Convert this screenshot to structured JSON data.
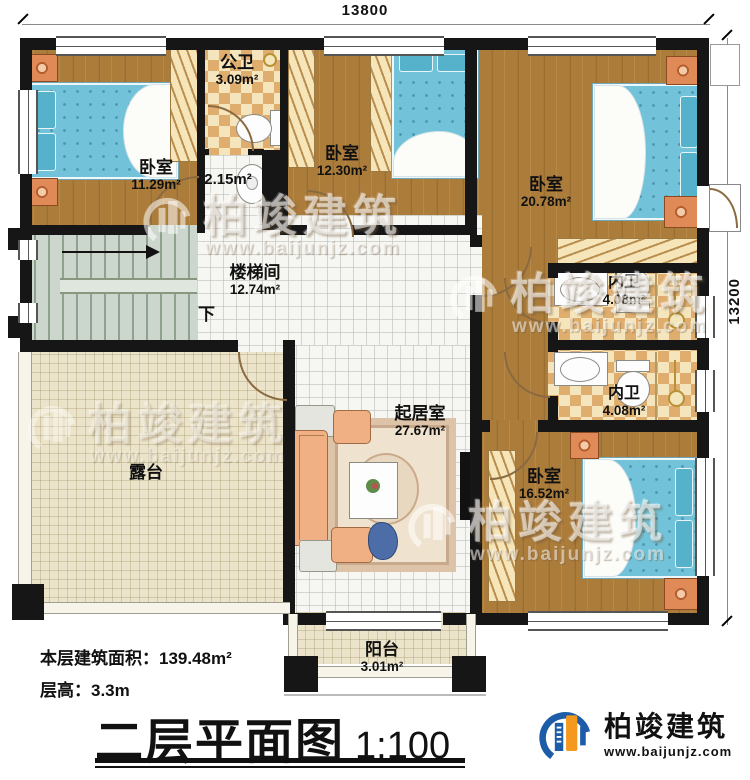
{
  "dimensions": {
    "top": "13800",
    "right": "13200"
  },
  "plan": {
    "rooms": {
      "bedroom_tl": {
        "name": "卧室",
        "area": "11.29m²"
      },
      "public_bath": {
        "name": "公卫",
        "area": "3.09m²"
      },
      "wash": {
        "area": "2.15m²"
      },
      "bedroom_tm": {
        "name": "卧室",
        "area": "12.30m²"
      },
      "bedroom_tr": {
        "name": "卧室",
        "area": "20.78m²"
      },
      "stairwell": {
        "name": "楼梯间",
        "area": "12.74m²",
        "down": "下"
      },
      "ensuite_top": {
        "name": "内卫",
        "area": "4.08m²"
      },
      "ensuite_bottom": {
        "name": "内卫",
        "area": "4.08m²"
      },
      "living": {
        "name": "起居室",
        "area": "27.67m²"
      },
      "terrace": {
        "name": "露台"
      },
      "bedroom_br": {
        "name": "卧室",
        "area": "16.52m²"
      },
      "balcony": {
        "name": "阳台",
        "area": "3.01m²"
      }
    }
  },
  "info": {
    "building_area": "本层建筑面积：139.48m²",
    "floor_height": "层高：3.3m"
  },
  "title": {
    "text": "二层平面图",
    "scale": "1:100"
  },
  "watermark": {
    "brand": "柏竣建筑",
    "url": "www.baijunjz.com"
  },
  "logo": {
    "brand": "柏竣建筑",
    "url": "www.baijunjz.com"
  },
  "colors": {
    "wall": "#161616",
    "wood": "#ac7c3b",
    "bath_tile": "#dfae6e",
    "bed": "#72c3d9",
    "terrace_tile": "#ece4ca",
    "stair": "#ccd6cc",
    "logo_blue": "#1c5ca8",
    "logo_orange": "#f5991e"
  }
}
